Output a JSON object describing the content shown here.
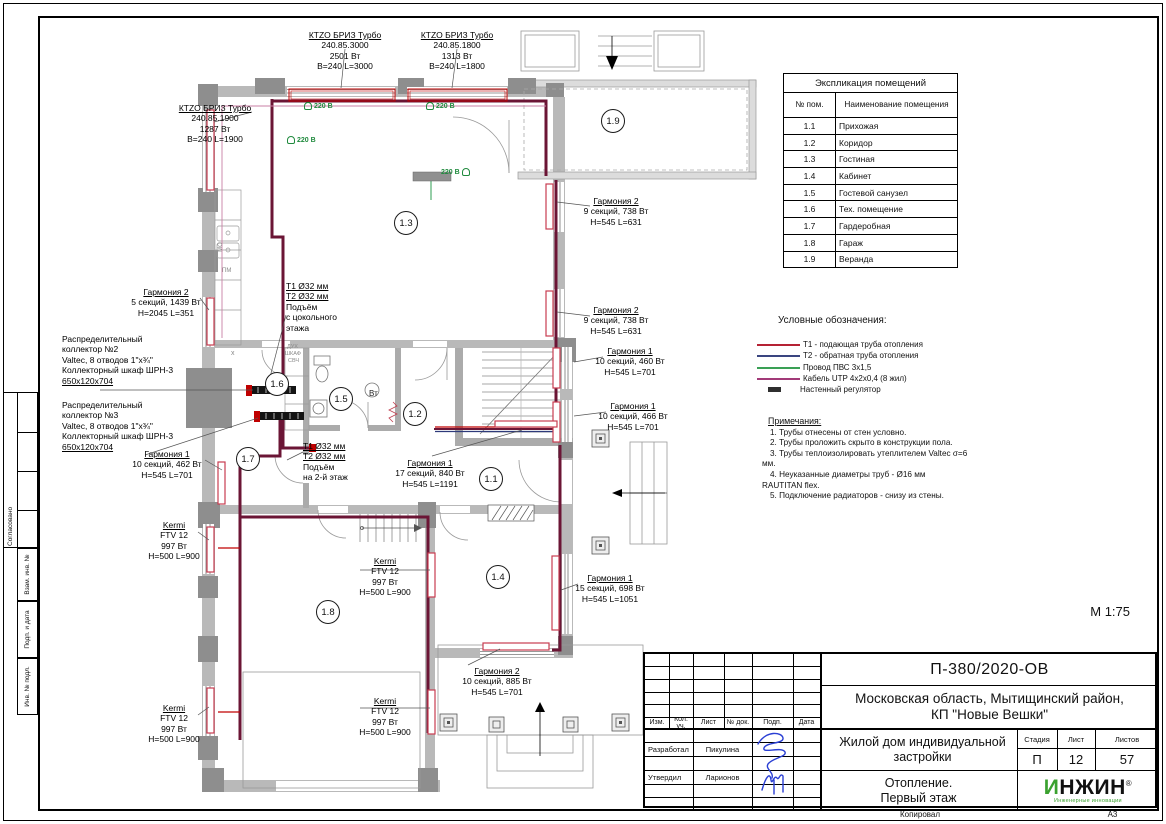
{
  "page": {
    "scale_label": "М 1:75",
    "copied_label": "Копировал",
    "format_label": "А3"
  },
  "side_stamp": {
    "items": [
      "Согласовано",
      "Взам. инв. №",
      "Подп. и дата",
      "Инв. № подл."
    ]
  },
  "explication": {
    "title": "Экспликация помещений",
    "col1": "№ пом.",
    "col2": "Наименование помещения",
    "rows": [
      [
        "1.1",
        "Прихожая"
      ],
      [
        "1.2",
        "Коридор"
      ],
      [
        "1.3",
        "Гостиная"
      ],
      [
        "1.4",
        "Кабинет"
      ],
      [
        "1.5",
        "Гостевой санузел"
      ],
      [
        "1.6",
        "Тех. помещение"
      ],
      [
        "1.7",
        "Гардеробная"
      ],
      [
        "1.8",
        "Гараж"
      ],
      [
        "1.9",
        "Веранда"
      ]
    ]
  },
  "legend": {
    "title": "Условные обозначения:",
    "items": [
      {
        "label": "Т1 - подающая труба отопления",
        "color": "#b52234",
        "type": "line"
      },
      {
        "label": "Т2 - обратная труба отопления",
        "color": "#3a4580",
        "type": "line"
      },
      {
        "label": "Провод ПВС 3х1,5",
        "color": "#3aa055",
        "type": "line"
      },
      {
        "label": "Кабель UTP 4х2х0,4 (8 жил)",
        "color": "#a23a78",
        "type": "line"
      },
      {
        "label": "Настенный регулятор",
        "color": "#2f2f2f",
        "type": "rect"
      }
    ]
  },
  "notes": {
    "title": "Примечания:",
    "items": [
      "1.  Трубы отнесены от стен условно.",
      "2.  Трубы проложить скрыто в конструкции пола.",
      "3.  Трубы теплоизолировать утеплителем Valtec σ=6 мм.",
      "4.  Неуказанные диаметры труб - Ø16 мм RAUTITAN flex.",
      "5.  Подключение радиаторов - снизу из стены."
    ]
  },
  "titleblock": {
    "doc_number": "П-380/2020-ОВ",
    "location_line1": "Московская область, Мытищинский район,",
    "location_line2": "КП \"Новые Вешки\"",
    "object_name": "Жилой дом индивидуальной застройки",
    "section_line1": "Отопление.",
    "section_line2": "Первый этаж",
    "stage_label": "Стадия",
    "sheet_label": "Лист",
    "sheets_label": "Листов",
    "stage": "П",
    "sheet": "12",
    "sheets": "57",
    "cols": [
      "Изм.",
      "Кол. уч.",
      "Лист",
      "№ док.",
      "Подп.",
      "Дата"
    ],
    "roles": [
      {
        "role": "Разработал",
        "name": "Пикулина"
      },
      {
        "role": "Утвердил",
        "name": "Ларионов"
      }
    ],
    "logo": {
      "first": "И",
      "rest": "НЖИН",
      "reg": "®",
      "subtitle": "Инженерные инновации"
    }
  },
  "plan": {
    "power_label": "220 В",
    "labels": [
      {
        "id": "ktzo-3000",
        "cx": 345,
        "y": 30,
        "lines": [
          {
            "t": "КТZО БРИЗ Турбо",
            "u": true
          },
          {
            "t": "240.85.3000"
          },
          {
            "t": "2501 Вт"
          },
          {
            "t": "В=240 L=3000"
          }
        ]
      },
      {
        "id": "ktzo-1800",
        "cx": 457,
        "y": 30,
        "lines": [
          {
            "t": "КТZО БРИЗ Турбо",
            "u": true
          },
          {
            "t": "240.85.1800"
          },
          {
            "t": "1313 Вт"
          },
          {
            "t": "В=240 L=1800"
          }
        ]
      },
      {
        "id": "ktzo-1900",
        "cx": 215,
        "y": 103,
        "lines": [
          {
            "t": "КТZО БРИЗ Турбо",
            "u": true
          },
          {
            "t": "240.85.1900"
          },
          {
            "t": "1287 Вт"
          },
          {
            "t": "В=240 L=1900"
          }
        ]
      },
      {
        "id": "garmoniya2-5s",
        "cx": 166,
        "y": 287,
        "lines": [
          {
            "t": "Гармония 2",
            "u": true
          },
          {
            "t": "5 секций, 1439 Вт"
          },
          {
            "t": "H=2045 L=351"
          }
        ]
      },
      {
        "id": "collector-2",
        "x": 62,
        "y": 334,
        "align": "l",
        "lines": [
          {
            "t": "Распределительный"
          },
          {
            "t": "коллектор №2"
          },
          {
            "t": "Valtec, 8 отводов 1\"х¾\""
          },
          {
            "t": "Коллекторный шкаф ШРН-3"
          },
          {
            "t": "650х120х704",
            "u": true
          }
        ]
      },
      {
        "id": "collector-3",
        "x": 62,
        "y": 400,
        "align": "l",
        "lines": [
          {
            "t": "Распределительный"
          },
          {
            "t": "коллектор №3"
          },
          {
            "t": "Valtec, 8 отводов 1\"х¾\""
          },
          {
            "t": "Коллекторный шкаф ШРН-3"
          },
          {
            "t": "650х120х704",
            "u": true
          }
        ]
      },
      {
        "id": "garmoniya1-462",
        "cx": 167,
        "y": 449,
        "lines": [
          {
            "t": "Гармония 1",
            "u": true
          },
          {
            "t": "10 секций, 462 Вт"
          },
          {
            "t": "H=545 L=701"
          }
        ]
      },
      {
        "id": "riser-basement",
        "x": 286,
        "y": 281,
        "align": "l",
        "lines": [
          {
            "t": "Т1 Ø32 мм",
            "u": true
          },
          {
            "t": "Т2 Ø32 мм",
            "u": true
          },
          {
            "t": "Подъём"
          },
          {
            "t": "с цокольного"
          },
          {
            "t": "этажа"
          }
        ]
      },
      {
        "id": "riser-2floor",
        "x": 303,
        "y": 441,
        "align": "l",
        "lines": [
          {
            "t": "Т1 Ø32 мм",
            "u": true
          },
          {
            "t": "Т2 Ø32 мм",
            "u": true
          },
          {
            "t": "Подъём"
          },
          {
            "t": "на 2-й этаж"
          }
        ]
      },
      {
        "id": "garmoniya2-738a",
        "cx": 616,
        "y": 196,
        "lines": [
          {
            "t": "Гармония 2",
            "u": true
          },
          {
            "t": "9 секций, 738 Вт"
          },
          {
            "t": "H=545 L=631"
          }
        ]
      },
      {
        "id": "garmoniya2-738b",
        "cx": 616,
        "y": 305,
        "lines": [
          {
            "t": "Гармония 2",
            "u": true
          },
          {
            "t": "9 секций, 738 Вт"
          },
          {
            "t": "H=545 L=631"
          }
        ]
      },
      {
        "id": "garmoniya1-460",
        "cx": 630,
        "y": 346,
        "lines": [
          {
            "t": "Гармония 1",
            "u": true
          },
          {
            "t": "10 секций, 460 Вт"
          },
          {
            "t": "H=545 L=701"
          }
        ]
      },
      {
        "id": "garmoniya1-466",
        "cx": 633,
        "y": 401,
        "lines": [
          {
            "t": "Гармония 1",
            "u": true
          },
          {
            "t": "10 секций, 466 Вт"
          },
          {
            "t": "H=545 L=701"
          }
        ]
      },
      {
        "id": "garmoniya1-840",
        "cx": 430,
        "y": 458,
        "lines": [
          {
            "t": "Гармония 1",
            "u": true
          },
          {
            "t": "17 секций, 840 Вт"
          },
          {
            "t": "H=545 L=1191"
          }
        ]
      },
      {
        "id": "garmoniya1-698",
        "cx": 610,
        "y": 573,
        "lines": [
          {
            "t": "Гармония 1",
            "u": true
          },
          {
            "t": "15 секций, 698 Вт"
          },
          {
            "t": "H=545 L=1051"
          }
        ]
      },
      {
        "id": "kermi-1",
        "cx": 174,
        "y": 520,
        "lines": [
          {
            "t": "Kermi",
            "u": true
          },
          {
            "t": "FTV 12"
          },
          {
            "t": "997 Вт"
          },
          {
            "t": "H=500 L=900"
          }
        ]
      },
      {
        "id": "kermi-2",
        "cx": 385,
        "y": 556,
        "lines": [
          {
            "t": "Kermi",
            "u": true
          },
          {
            "t": "FTV 12"
          },
          {
            "t": "997 Вт"
          },
          {
            "t": "H=500 L=900"
          }
        ]
      },
      {
        "id": "kermi-3",
        "cx": 174,
        "y": 703,
        "lines": [
          {
            "t": "Kermi",
            "u": true
          },
          {
            "t": "FTV 12"
          },
          {
            "t": "997 Вт"
          },
          {
            "t": "H=500 L=900"
          }
        ]
      },
      {
        "id": "kermi-4",
        "cx": 385,
        "y": 696,
        "lines": [
          {
            "t": "Kermi",
            "u": true
          },
          {
            "t": "FTV 12"
          },
          {
            "t": "997 Вт"
          },
          {
            "t": "H=500 L=900"
          }
        ]
      },
      {
        "id": "garmoniya2-885",
        "cx": 497,
        "y": 666,
        "lines": [
          {
            "t": "Гармония 2",
            "u": true
          },
          {
            "t": "10 секций, 885 Вт"
          },
          {
            "t": "H=545 L=701"
          }
        ]
      }
    ],
    "rooms": [
      {
        "n": "1.1",
        "x": 490,
        "y": 478
      },
      {
        "n": "1.2",
        "x": 414,
        "y": 413
      },
      {
        "n": "1.3",
        "x": 405,
        "y": 222
      },
      {
        "n": "1.4",
        "x": 497,
        "y": 576
      },
      {
        "n": "1.5",
        "x": 340,
        "y": 398
      },
      {
        "n": "1.6",
        "x": 276,
        "y": 383
      },
      {
        "n": "1.7",
        "x": 247,
        "y": 458
      },
      {
        "n": "1.8",
        "x": 327,
        "y": 611
      },
      {
        "n": "1.9",
        "x": 612,
        "y": 120
      }
    ],
    "power": [
      {
        "x": 308,
        "y": 106,
        "side": "r"
      },
      {
        "x": 430,
        "y": 106,
        "side": "r"
      },
      {
        "x": 291,
        "y": 140,
        "side": "r"
      },
      {
        "x": 445,
        "y": 172,
        "side": "l"
      }
    ],
    "small_texts": [
      {
        "t": "ДУХ",
        "x": 287,
        "y": 345,
        "s": 5.5
      },
      {
        "t": "ШКАФ",
        "x": 285,
        "y": 352,
        "s": 5.5
      },
      {
        "t": "СВЧ",
        "x": 288,
        "y": 359,
        "s": 5.5
      },
      {
        "t": "х",
        "x": 231,
        "y": 350,
        "s": 7
      },
      {
        "t": "ПМ",
        "x": 222,
        "y": 268,
        "s": 6
      },
      {
        "t": "МО",
        "x": 216,
        "y": 244,
        "s": 6,
        "r": -90
      },
      {
        "t": "Вт",
        "x": 369,
        "y": 390,
        "s": 8,
        "c": "#222"
      }
    ]
  }
}
